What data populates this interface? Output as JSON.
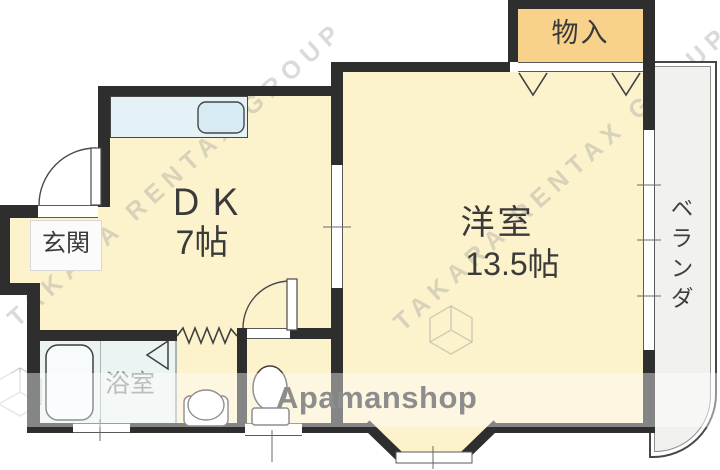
{
  "floorplan": {
    "rooms": {
      "dk": {
        "label": "ＤＫ",
        "size": "7帖"
      },
      "western": {
        "label": "洋室",
        "size": "13.5帖"
      },
      "storage": {
        "label": "物入"
      },
      "entrance": {
        "label": "玄関"
      },
      "bath": {
        "label": "浴室"
      },
      "veranda": {
        "label": "ベランダ"
      }
    },
    "watermark": {
      "brand": "Apamanshop",
      "agency": "TAKARA RENTAX GROUP"
    },
    "colors": {
      "room_fill": "#fcf2cb",
      "storage_fill": "#f8d18b",
      "bath_fill": "#ecf4f3",
      "counter_fill": "#e4f1f7",
      "veranda_fill": "#f1f1ee",
      "wall": "#2e2e2e"
    }
  }
}
